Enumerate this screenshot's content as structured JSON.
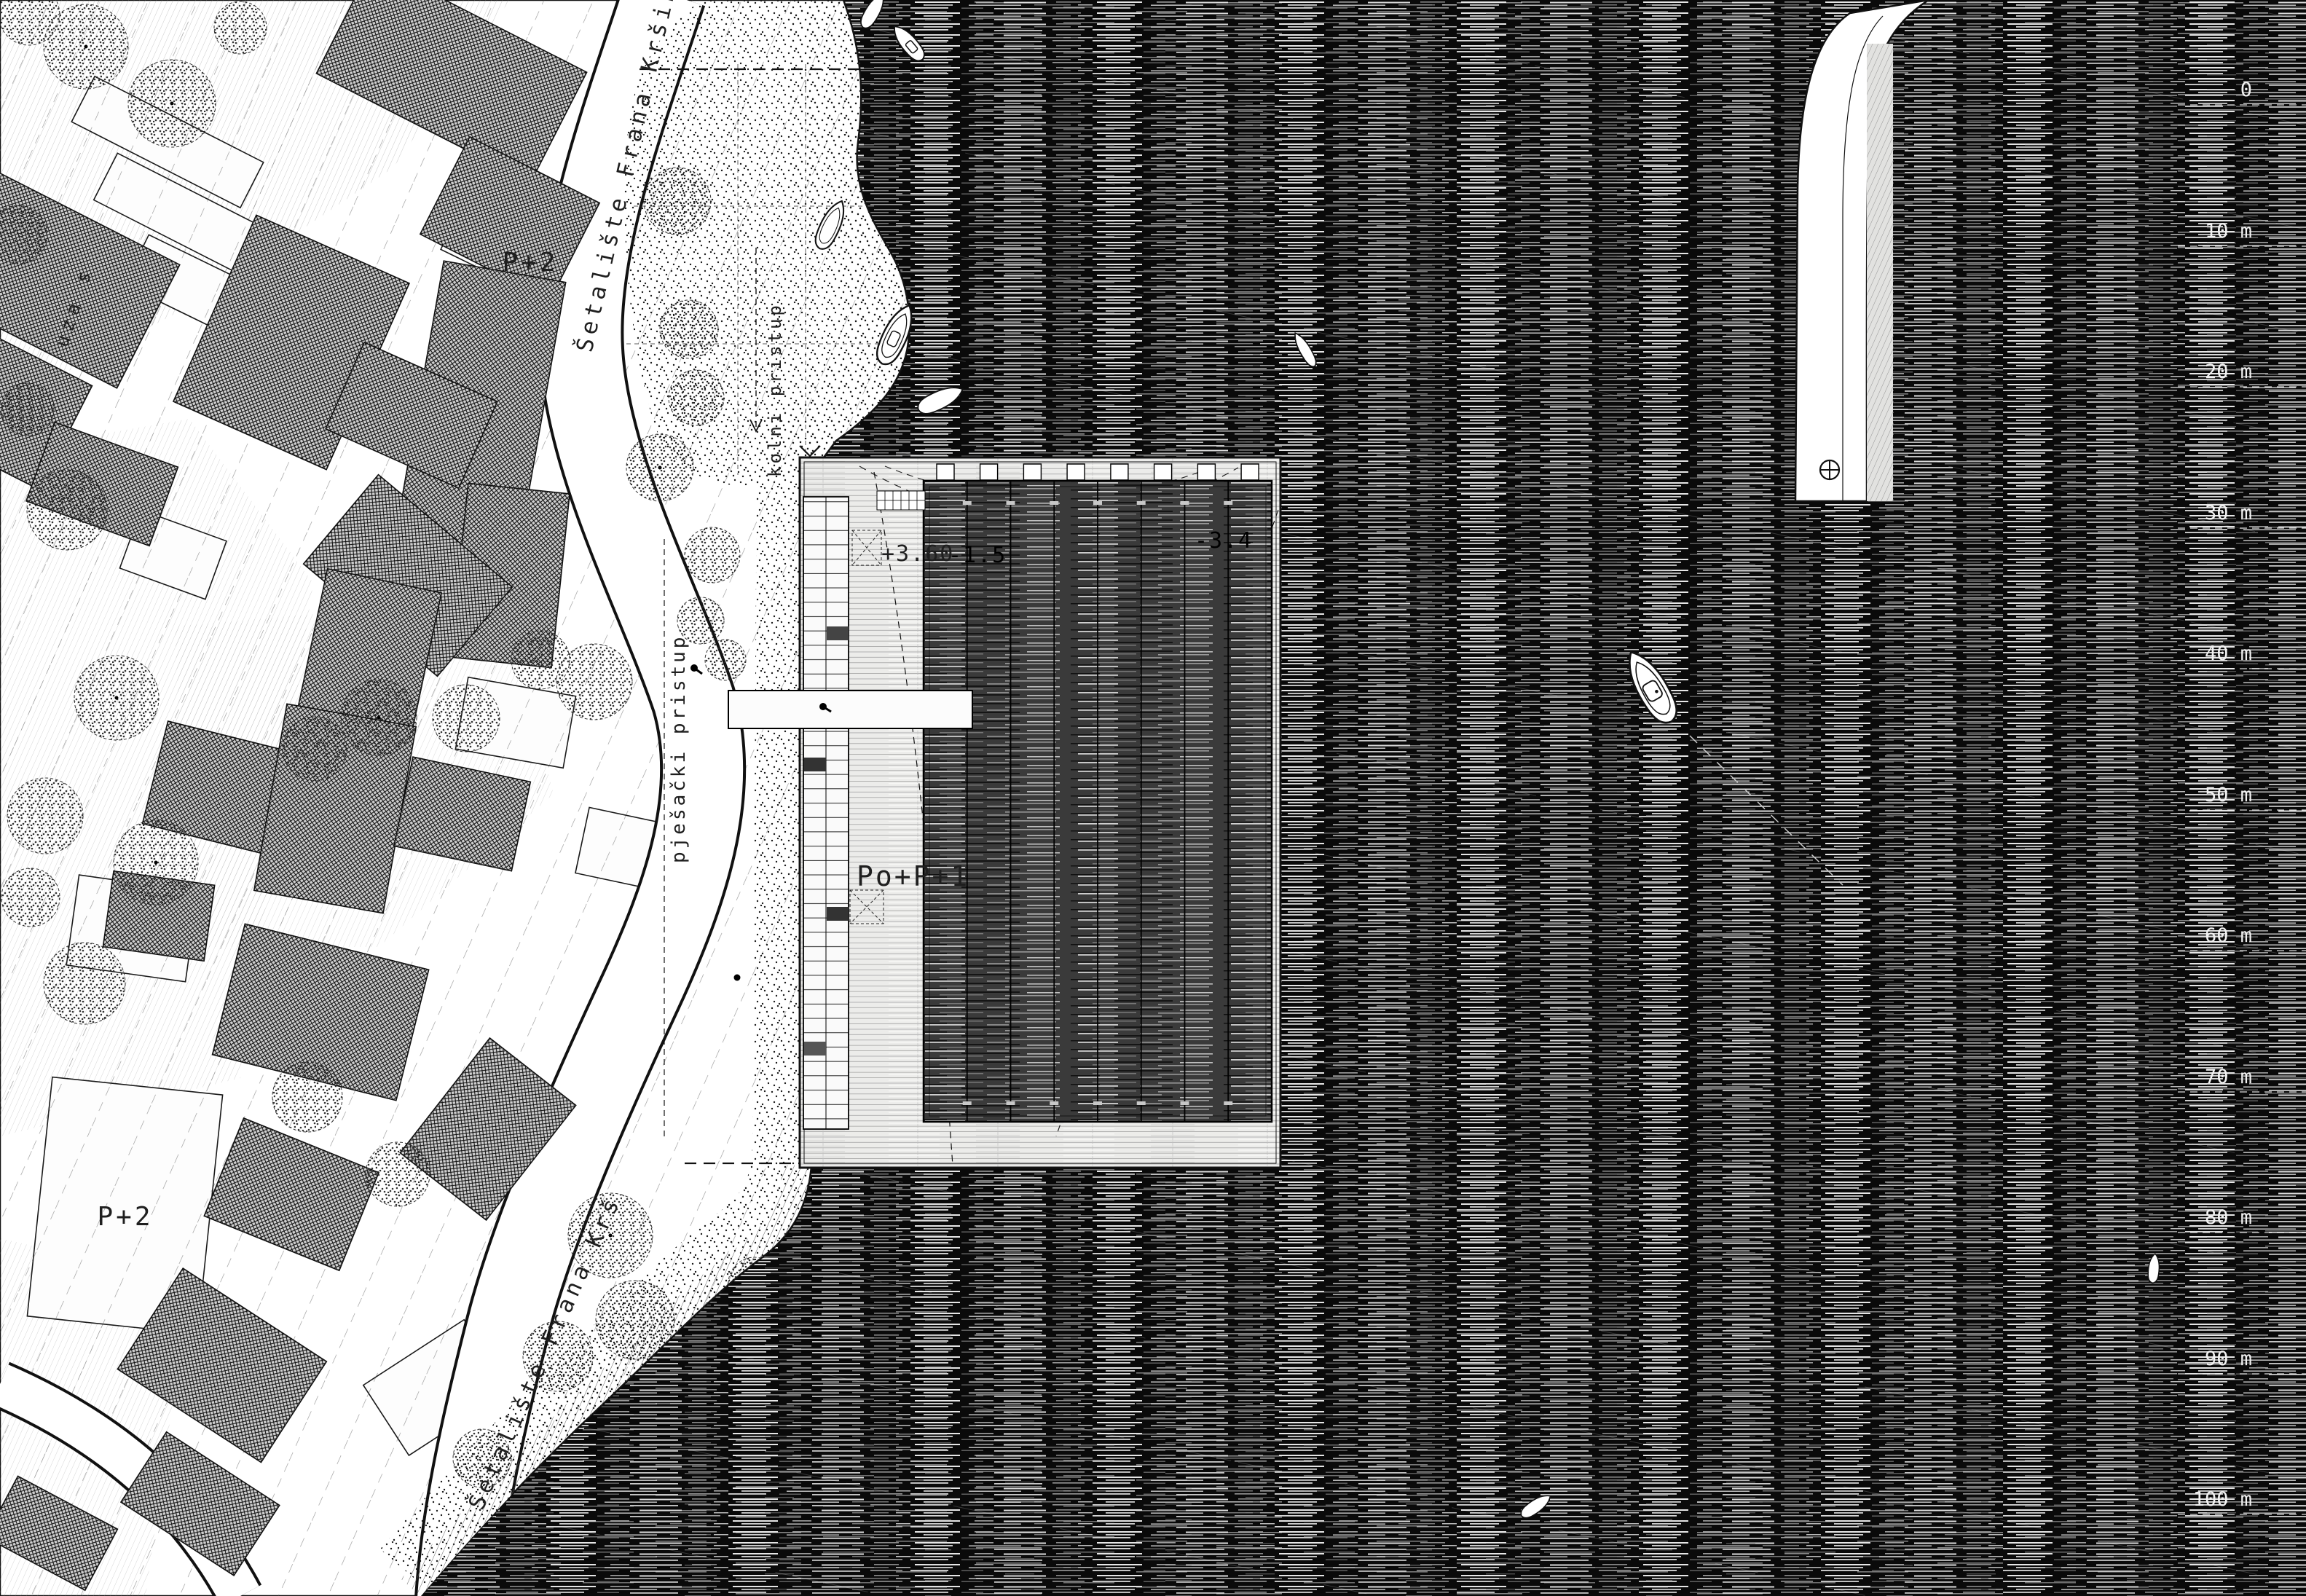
{
  "labels": {
    "street_promenade_top": "Šetalište Frana Kršinica",
    "street_promenade_bottom": "Šetalište Frana Krš",
    "street_side": "uza s",
    "vehicle_access": "kolni pristup",
    "pedestrian_access": "pješački pristup",
    "building_upper_floors": "P+2",
    "building_lower_floors": "P+2",
    "pool_building_floors": "Po+P+1",
    "deck_elevation": "+3.60",
    "pool_depth_shallow": "-1.5",
    "pool_depth_deep": "-3.4"
  },
  "scale_bar": {
    "unit": "m",
    "ticks": [
      "0",
      "10 m",
      "20 m",
      "30 m",
      "40 m",
      "50 m",
      "60 m",
      "70 m",
      "80 m",
      "90 m",
      "100 m"
    ]
  },
  "colors": {
    "sea": "#0a0a0a",
    "pool": "#3a3a3a",
    "land": "#ffffff",
    "ink": "#111111",
    "deck": "#ececea"
  }
}
